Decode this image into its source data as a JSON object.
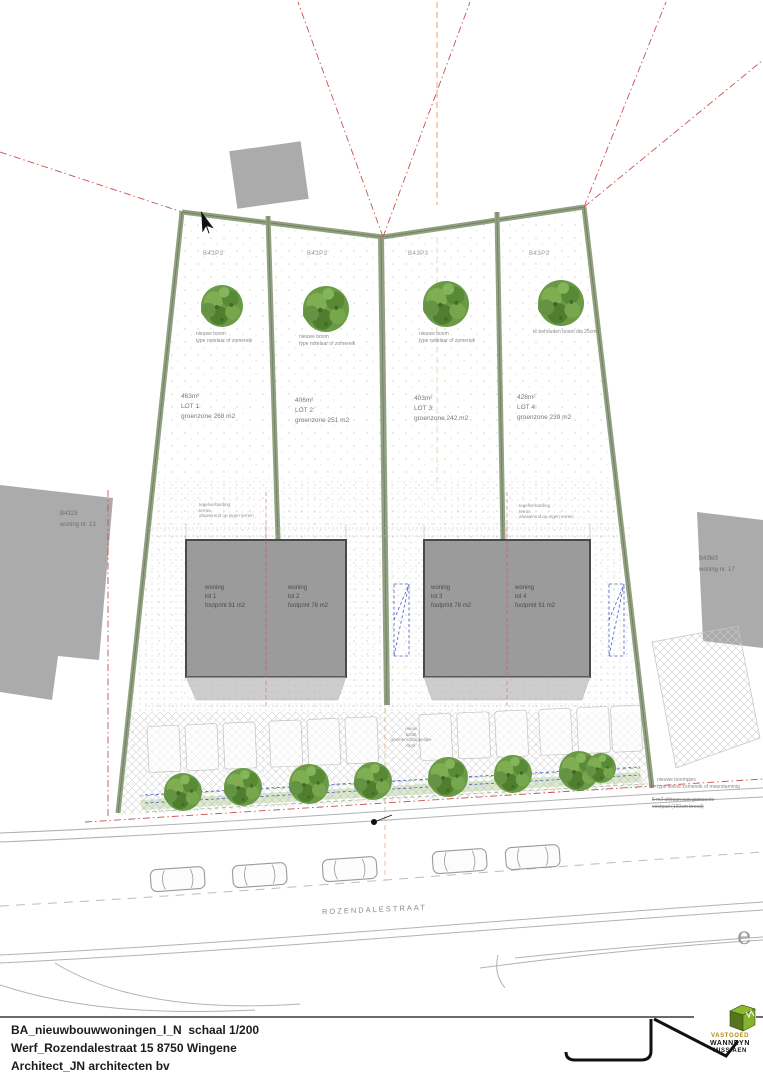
{
  "title_block": {
    "line1": "BA_nieuwbouwwoningen_I_N  schaal 1/200",
    "line2": "Werf_Rozendalestraat 15 8750 Wingene",
    "line3": "Architect_JN architecten bv"
  },
  "brand": {
    "word1": "VASTGOED",
    "word2": "WANNEYN",
    "word3": "MISSIAEN"
  },
  "street": {
    "name": "ROZENDALESTRAAT",
    "stray_letter": "e"
  },
  "lots": [
    {
      "code": "B43P3",
      "area": "463m²",
      "label": "LOT 1:",
      "greenzone": "groenzone 268 m2",
      "tree1": "nieuwe boom",
      "tree2": "type notelaar of zomereik"
    },
    {
      "code": "B43P3",
      "area": "406m²",
      "label": "LOT 2:",
      "greenzone": "groenzone 251 m2",
      "tree1": "nieuwe boom",
      "tree2": "type notelaar of zomereik"
    },
    {
      "code": "B43P3",
      "area": "403m²",
      "label": "LOT 3:",
      "greenzone": "groenzone 242 m2",
      "tree1": "nieuwe boom",
      "tree2": "type notelaar of zomereik"
    },
    {
      "code": "B43P3",
      "area": "428m²",
      "label": "LOT 4:",
      "greenzone": "groenzone 239 m2",
      "tree1": "te behouden boom dia 25cm",
      "tree2": ""
    }
  ],
  "houses": [
    {
      "line1": "woning",
      "line2": "lot 1",
      "line3": "footprint 91 m2"
    },
    {
      "line1": "woning",
      "line2": "lot 2",
      "line3": "footprint 78 m2"
    },
    {
      "line1": "woning",
      "line2": "lot 3",
      "line3": "footprint 78 m2"
    },
    {
      "line1": "woning",
      "line2": "lot 4",
      "line3": "footprint 91 m2"
    }
  ],
  "neighbors": {
    "left_code": "B4323",
    "left_name": "woning nr. 13",
    "right_code": "B43M3",
    "right_name": "woning nr. 17"
  },
  "annotations": {
    "paving1": "tegelverharding",
    "paving2": "terras",
    "paving3": "afwaterend op eigen terrein",
    "drive1": "nieuw",
    "drive2": "asfalt",
    "drive3": "gemeenschappelijke",
    "drive4": "oprit",
    "small_trees1": "nieuwe boompjes",
    "small_trees2": "type kleine zomereik of meerstammig",
    "cede1": "5 m2 afstaan aan gemeente",
    "cede2": "voetpad (100cm breed)"
  },
  "colors": {
    "hedge_green": "#90a080",
    "house_gray": "#9b9b9b",
    "neighbor_gray": "#ababab",
    "tree_green": "#6a9a45",
    "boundary_red": "#c85050",
    "utility_blue": "#4a5ec8",
    "brand_green": "#86b32c",
    "brand_gold": "#b08c1a"
  }
}
